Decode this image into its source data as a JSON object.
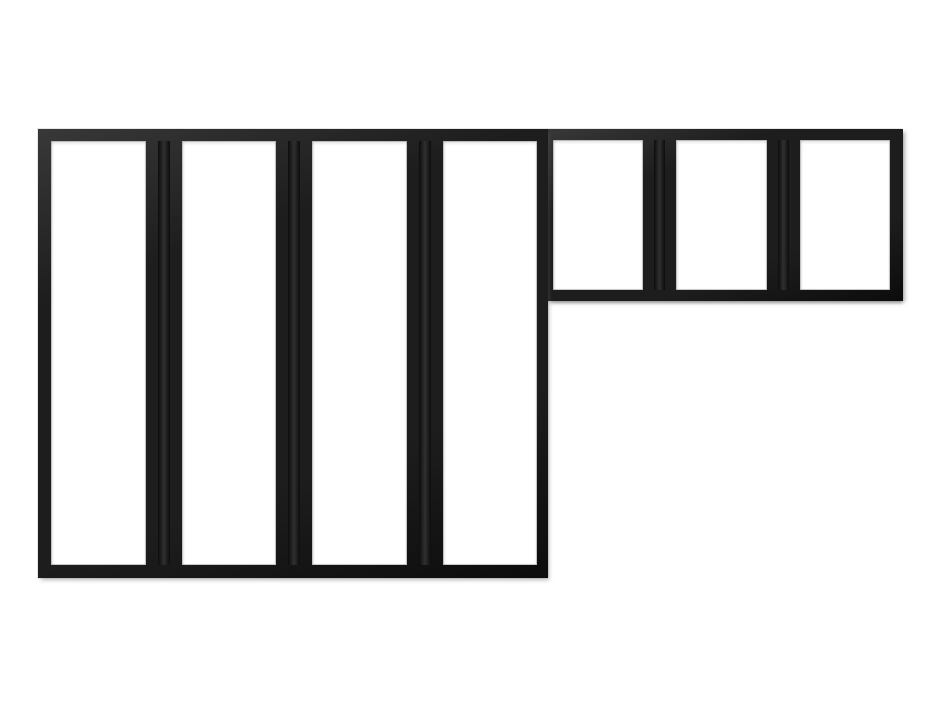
{
  "product_image": {
    "subject": "L-shaped black metal-framed glass partition",
    "style": "industrial loft canopy window (verriere)",
    "sections": [
      {
        "id": "tall-section",
        "pane_count": 4,
        "pane_shape": "tall vertical rectangles"
      },
      {
        "id": "short-section",
        "pane_count": 3,
        "pane_shape": "short vertical rectangles"
      }
    ],
    "total_panes": 7
  },
  "colors": {
    "frame": "#1d1d1d",
    "frame_highlight": "#383838",
    "frame_shadow": "#0c0c0c",
    "pane": "#ffffff",
    "background": "#ffffff",
    "outer_shadow": "#c9c9c9"
  }
}
